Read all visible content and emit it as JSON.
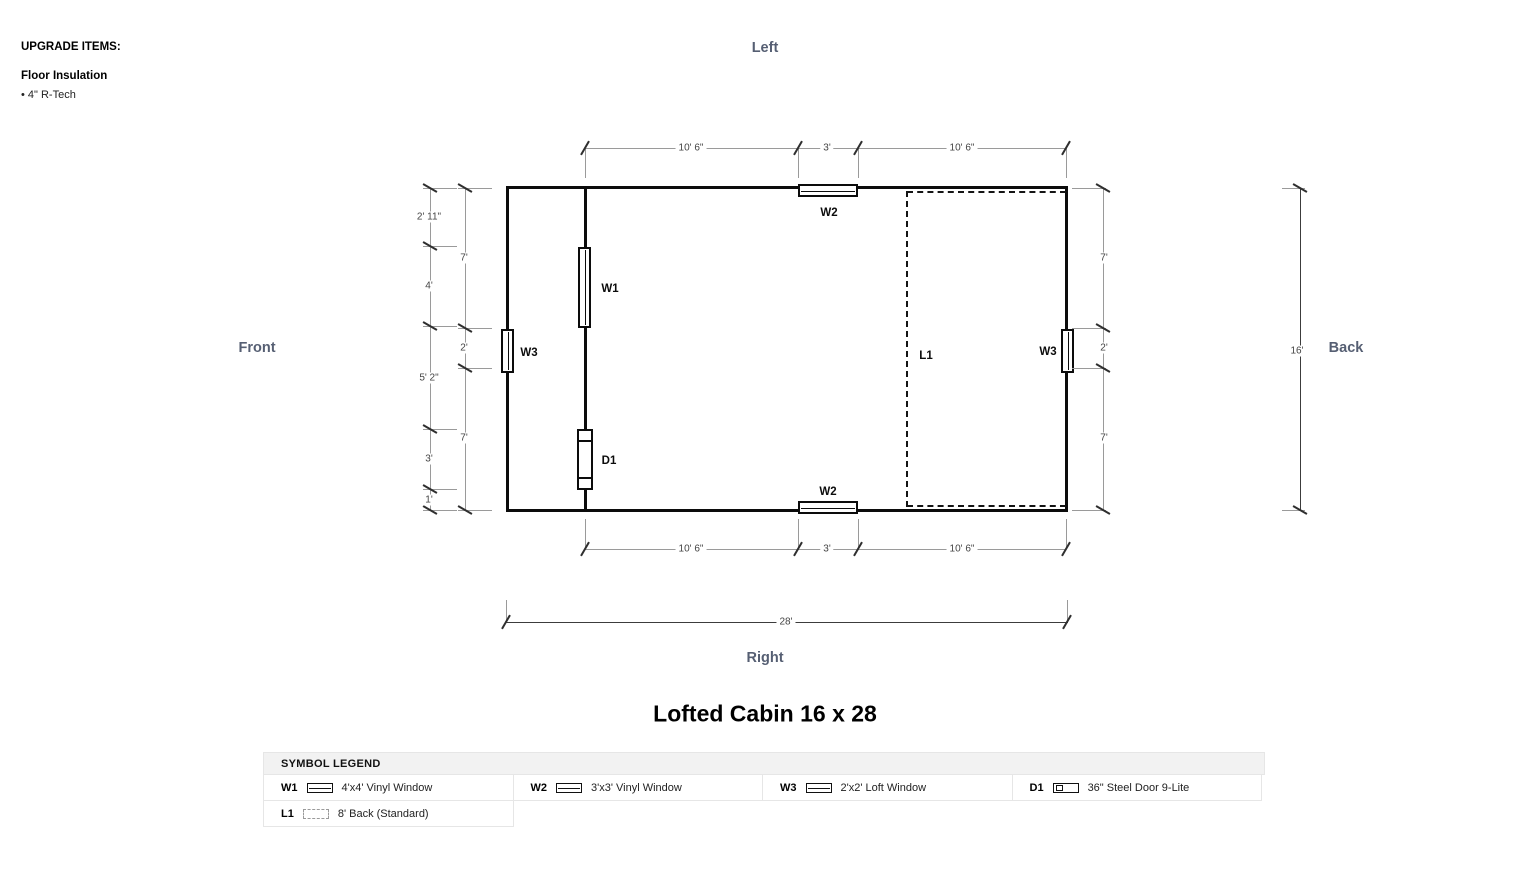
{
  "upgrade_items": {
    "heading": "UPGRADE ITEMS:",
    "items": [
      {
        "title": "Floor Insulation",
        "detail": "• 4\" R-Tech"
      }
    ]
  },
  "orientation_labels": {
    "top": "Left",
    "left": "Front",
    "right": "Back",
    "bottom": "Right"
  },
  "plan_title": "Lofted Cabin 16 x 28",
  "plan": {
    "symbol_labels": {
      "w1": "W1",
      "w2_top": "W2",
      "w2_bottom": "W2",
      "w3_left": "W3",
      "w3_right": "W3",
      "d1": "D1",
      "l1": "L1"
    },
    "dims": {
      "top": [
        "10' 6\"",
        "3'",
        "10' 6\""
      ],
      "bottom": [
        "10' 6\"",
        "3'",
        "10' 6\""
      ],
      "left_outer": [
        "2' 11\"",
        "4'",
        "5' 2\"",
        "3'",
        "1'"
      ],
      "left_inner": [
        "7'",
        "2'",
        "7'"
      ],
      "right_inner": [
        "7'",
        "2'",
        "7'"
      ],
      "height_total": "16'",
      "width_total": "28'"
    }
  },
  "legend": {
    "header": "SYMBOL LEGEND",
    "entries": [
      {
        "code": "W1",
        "symbol": "window-symbol-icon",
        "label": "4'x4' Vinyl Window"
      },
      {
        "code": "W2",
        "symbol": "window-symbol-icon",
        "label": "3'x3' Vinyl Window"
      },
      {
        "code": "W3",
        "symbol": "window-symbol-icon",
        "label": "2'x2' Loft Window"
      },
      {
        "code": "D1",
        "symbol": "door-symbol-icon",
        "label": "36\" Steel Door 9-Lite"
      },
      {
        "code": "L1",
        "symbol": "loft-dashed-symbol-icon",
        "label": "8' Back (Standard)"
      }
    ]
  },
  "colors": {
    "orientation_label": "#565f73",
    "wall": "#0c0c0c",
    "dimension_line": "#9a9a9a",
    "dimension_text": "#444444",
    "legend_header_bg": "#f2f2f2"
  }
}
